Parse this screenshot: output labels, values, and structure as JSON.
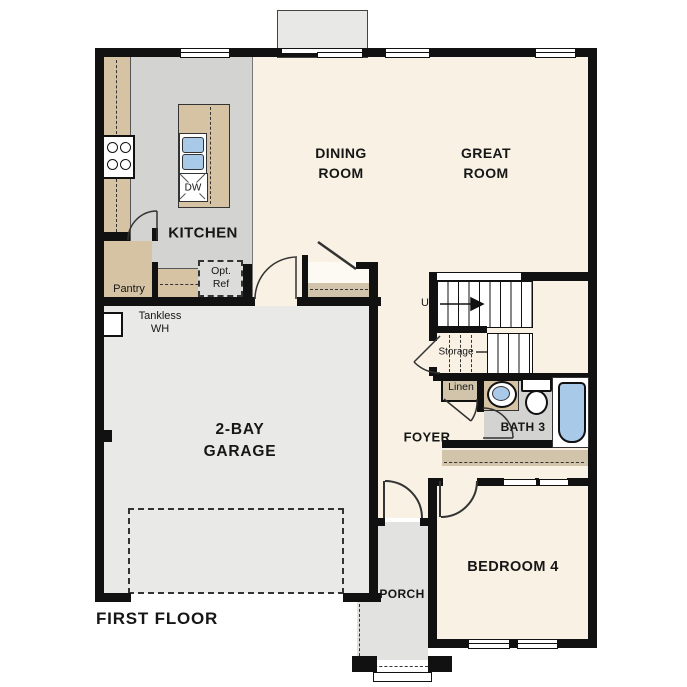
{
  "floor_label": "FIRST FLOOR",
  "labels": {
    "kitchen": "KITCHEN",
    "dining1": "DINING",
    "dining2": "ROOM",
    "great1": "GREAT",
    "great2": "ROOM",
    "garage1": "2-BAY",
    "garage2": "GARAGE",
    "foyer": "FOYER",
    "bath": "BATH 3",
    "bedroom": "BEDROOM 4",
    "porch": "PORCH"
  },
  "annotations": {
    "pantry": "Pantry",
    "opt_ref1": "Opt.",
    "opt_ref2": "Ref",
    "dishwasher": "DW",
    "tankless1": "Tankless",
    "tankless2": "WH",
    "up": "Up",
    "storage": "Storage",
    "linen": "Linen"
  },
  "colors": {
    "wall": "#111111",
    "floor_cream": "#f8f1e4",
    "tile_gray": "#d3d3d1",
    "garage_gray": "#e9e9e7",
    "porch_gray": "#e2e2e0",
    "counter_tan": "#d5c3a4",
    "closet_tan": "#d1c4aa",
    "fixture_blue": "#a9c9e9",
    "background": "#ffffff"
  }
}
